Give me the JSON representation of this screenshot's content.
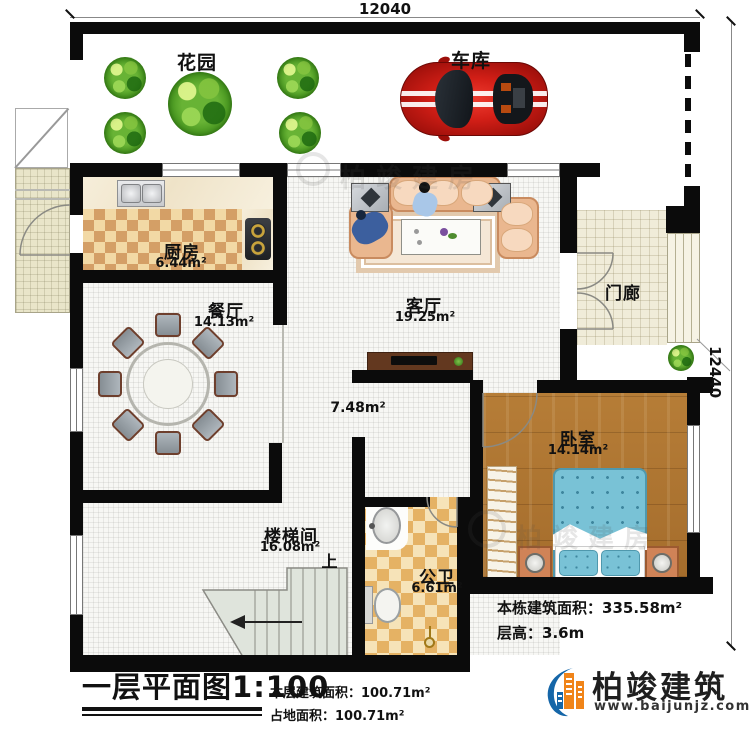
{
  "dimensions": {
    "top": "12040",
    "right": "12440"
  },
  "rooms": {
    "garden": {
      "name": "花园"
    },
    "garage": {
      "name": "车库"
    },
    "kitchen": {
      "name": "厨房",
      "area": "6.44m²"
    },
    "dining": {
      "name": "餐厅",
      "area": "14.13m²"
    },
    "living": {
      "name": "客厅",
      "area": "19.25m²"
    },
    "porch": {
      "name": "门廊"
    },
    "hall": {
      "area": "7.48m²"
    },
    "bedroom": {
      "name": "卧室",
      "area": "14.14m²"
    },
    "stairwell": {
      "name": "楼梯间",
      "area": "16.08m²",
      "up": "上"
    },
    "bathroom": {
      "name": "公卫",
      "area": "6.61m²"
    }
  },
  "title": {
    "main": "一层平面图",
    "scale": "1:100"
  },
  "stats": {
    "floor_area_label": "本层建筑面积：",
    "floor_area_value": "100.71m²",
    "footprint_label": "占地面积：",
    "footprint_value": "100.71m²",
    "building_area_label": "本栋建筑面积：",
    "building_area_value": "335.58m²",
    "storey_height_label": "层高：",
    "storey_height_value": "3.6m"
  },
  "brand": {
    "name": "柏竣建筑",
    "website": "www.baijunjz.com",
    "watermark": "柏竣建房",
    "accent_blue": "#1566a8",
    "accent_orange": "#f08419"
  },
  "colors": {
    "wall": "#0b0b0b",
    "bedroom_floor": "#a9712f",
    "bed": "#79c2d6",
    "kitchen_checker": "#d49f66",
    "bathroom_checker": "#e5b264",
    "car": "#c41818"
  }
}
